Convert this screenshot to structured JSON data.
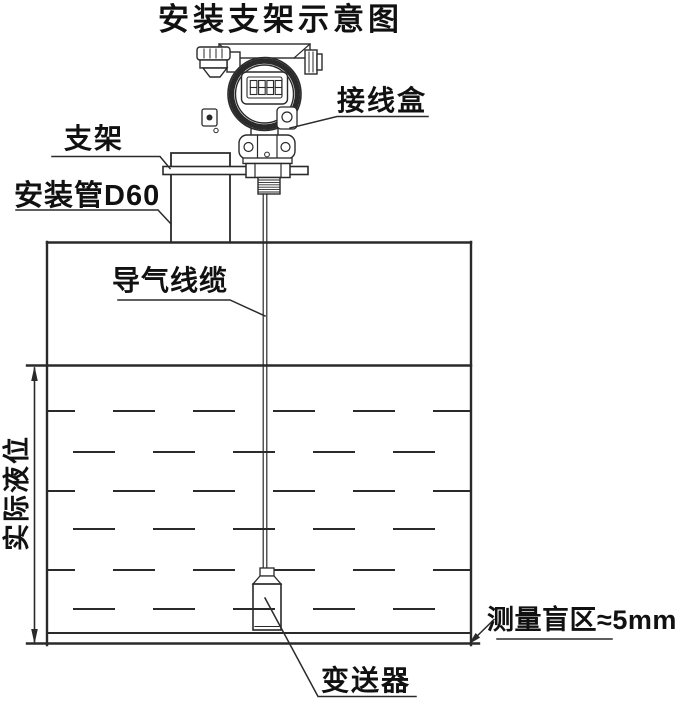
{
  "title": "安装支架示意图",
  "labels": {
    "junction_box": "接线盒",
    "bracket": "支架",
    "mounting_pipe": "安装管D60",
    "air_cable": "导气线缆",
    "actual_level": "实际液位",
    "blind_zone": "测量盲区≈5mm",
    "transmitter": "变送器"
  },
  "display": {
    "digits": "8888"
  },
  "colors": {
    "line": "#2a2a2a",
    "text": "#111111",
    "background": "#ffffff"
  }
}
